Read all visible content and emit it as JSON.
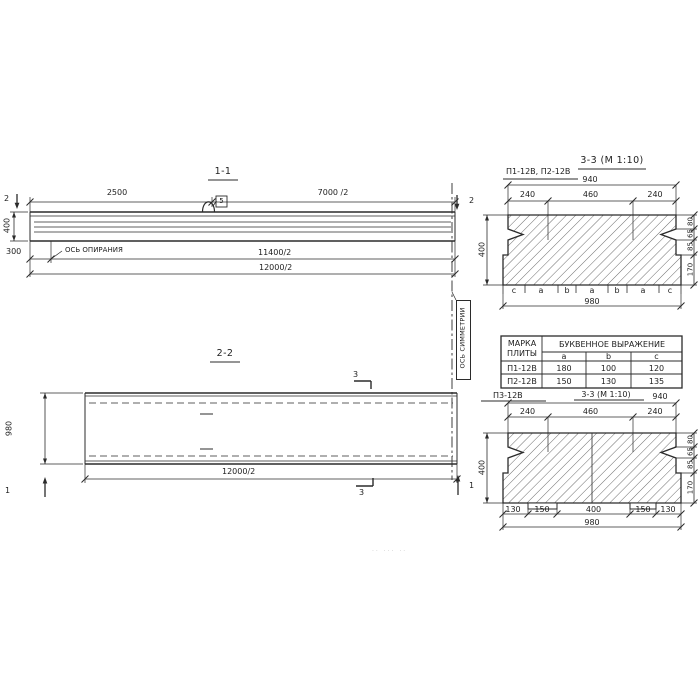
{
  "sec11": {
    "title": "1-1",
    "dim_2500": "2500",
    "dim_7000_2": "7000 /2",
    "dim_400": "400",
    "dim_300": "300",
    "bearing_axis_label": "ОСЬ ОПИРАНИЯ",
    "dim_11400_2": "11400/2",
    "dim_12000_2": "12000/2",
    "cut_left": "2",
    "cut_right": "2",
    "loop_flag": "5"
  },
  "symmetry_axis_label": "ОСЬ СИММЕТРИИ",
  "sec22": {
    "title": "2-2",
    "dim_980": "980",
    "dim_12000_2": "12000/2",
    "cut_top": "3",
    "cut_bottom": "3",
    "cut_left": "1",
    "cut_right": "1"
  },
  "sec33_top": {
    "title": "3-3 (М 1:10)",
    "marks": "П1-12В, П2-12В",
    "dim_940": "940",
    "dims_top": [
      "240",
      "460",
      "240"
    ],
    "dim_400": "400",
    "dims_right": [
      "80",
      "65",
      "85",
      "170"
    ],
    "letters": [
      "c",
      "a",
      "b",
      "a",
      "b",
      "a",
      "c"
    ],
    "dim_980": "980"
  },
  "table": {
    "header_col1_line1": "МАРКА",
    "header_col1_line2": "ПЛИТЫ",
    "header_expr": "БУКВЕННОЕ  ВЫРАЖЕНИЕ",
    "cols": [
      "a",
      "b",
      "c"
    ],
    "rows": [
      {
        "mark": "П1-12В",
        "a": "180",
        "b": "100",
        "c": "120"
      },
      {
        "mark": "П2-12В",
        "a": "150",
        "b": "130",
        "c": "135"
      }
    ]
  },
  "sec33_bottom": {
    "mark": "П3-12В",
    "title": "3-3 (М 1:10)",
    "dim_940": "940",
    "dims_top": [
      "240",
      "460",
      "240"
    ],
    "dim_400": "400",
    "dims_right": [
      "80",
      "65",
      "85",
      "170"
    ],
    "dims_bottom": [
      "130",
      "150",
      "400",
      "150",
      "130"
    ],
    "dim_980": "980"
  },
  "scan_artifact": "·· ··· ··"
}
